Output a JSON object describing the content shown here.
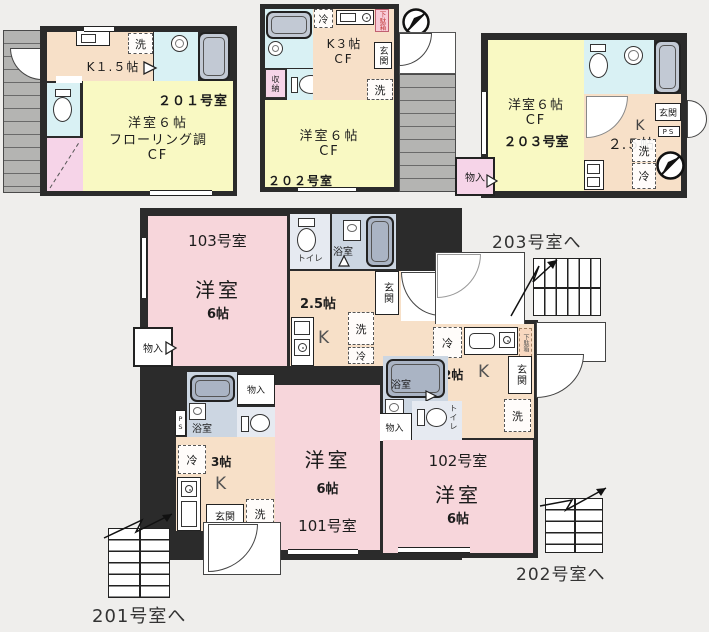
{
  "colors": {
    "wall": "#2b2b2b",
    "room_pink": "#f7d6db",
    "room_yellow": "#f9f9c3",
    "kitchen_peach": "#f7e0c8",
    "bath_cyan": "#d9f1f4",
    "wet_gray": "#ccd6e2",
    "closet_pink": "#f6d4e8",
    "stairs_gray": "#b4b4b2",
    "tub_gray": "#c2c9d4",
    "shoe_label_red": "#c23b3b"
  },
  "u201": {
    "room_no": "２０１号室",
    "kitchen": "K１.５帖",
    "wash": "洗",
    "main_line1": "洋室６帖",
    "main_line2": "フローリング調",
    "main_line3": "CF"
  },
  "u202": {
    "room_no": "２０２号室",
    "fridge": "冷",
    "kitchen_line1": "K３帖",
    "kitchen_line2": "CF",
    "shoe_box": "下駄箱",
    "entrance": "玄関",
    "wash": "洗",
    "closet": "収納",
    "main_line1": "洋室６帖",
    "main_line2": "CF"
  },
  "u203": {
    "room_no": "２０３号室",
    "main_line1": "洋室６帖",
    "main_line2": "CF",
    "kitchen_line1": "K",
    "kitchen_line2": "２.５帖",
    "entrance": "玄関",
    "ps": "PS",
    "wash": "洗",
    "fridge": "冷",
    "storage": "物入"
  },
  "f1": {
    "u103": {
      "room_no": "103号室",
      "main1": "洋室",
      "main2": "6帖",
      "toilet": "トイレ",
      "bath": "浴室",
      "ksize": "2.5帖",
      "k": "K",
      "entrance": "玄関",
      "wash": "洗",
      "fridge": "冷",
      "storage": "物入"
    },
    "u102": {
      "room_no": "102号室",
      "main1": "洋室",
      "main2": "6帖",
      "toilet": "トイレ",
      "bath": "浴室",
      "ksize": "2帖",
      "k": "K",
      "entrance": "玄関",
      "wash": "洗",
      "fridge": "冷",
      "storage": "物入",
      "shoe_box": "下駄箱"
    },
    "u101": {
      "room_no": "101号室",
      "main1": "洋室",
      "main2": "6帖",
      "toilet": "トイレ",
      "bath": "浴室",
      "ksize": "3帖",
      "k": "K",
      "entrance": "玄関",
      "wash": "洗",
      "fridge": "冷",
      "storage": "物入",
      "ps": "PS"
    }
  },
  "stairs": {
    "to_201": "201号室へ",
    "to_202": "202号室へ",
    "to_203": "203号室へ"
  }
}
